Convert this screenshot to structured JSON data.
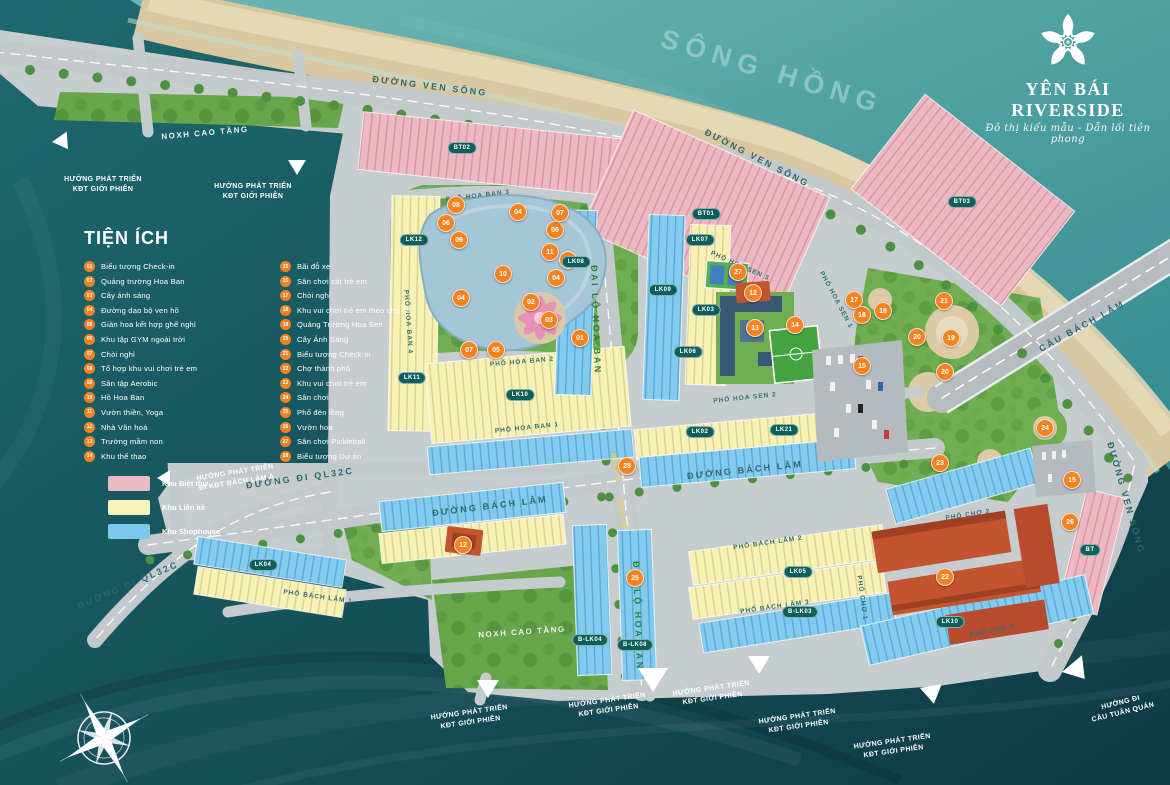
{
  "logo": {
    "title": "YÊN BÁI RIVERSIDE",
    "tagline": "Đô thị kiểu mẫu - Dẫn lối tiên phong"
  },
  "river_label": "SÔNG HỒNG",
  "legend": {
    "title": "TIỆN ÍCH",
    "items": [
      {
        "n": "01",
        "label": "Biểu tượng Check-in"
      },
      {
        "n": "02",
        "label": "Quảng trường Hoa Ban"
      },
      {
        "n": "03",
        "label": "Cây ánh sáng"
      },
      {
        "n": "04",
        "label": "Đường dạo bộ ven hồ"
      },
      {
        "n": "05",
        "label": "Giàn hoa kết hợp ghế nghỉ"
      },
      {
        "n": "06",
        "label": "Khu tập GYM ngoài trời"
      },
      {
        "n": "07",
        "label": "Chòi nghỉ"
      },
      {
        "n": "08",
        "label": "Tổ hợp khu vui chơi trẻ em"
      },
      {
        "n": "09",
        "label": "Sân tập Aerobic"
      },
      {
        "n": "10",
        "label": "Hồ Hoa Ban"
      },
      {
        "n": "11",
        "label": "Vườn thiền, Yoga"
      },
      {
        "n": "12",
        "label": "Nhà Văn hoá"
      },
      {
        "n": "13",
        "label": "Trường mầm non"
      },
      {
        "n": "14",
        "label": "Khu thể thao"
      },
      {
        "n": "15",
        "label": "Bãi đỗ xe"
      },
      {
        "n": "16",
        "label": "Sân chơi cát trẻ em"
      },
      {
        "n": "17",
        "label": "Chòi nghỉ"
      },
      {
        "n": "18",
        "label": "Khu vui chơi trẻ em theo chủ đề"
      },
      {
        "n": "19",
        "label": "Quảng Trường Hoa Sen"
      },
      {
        "n": "20",
        "label": "Cây Ánh Sáng"
      },
      {
        "n": "21",
        "label": "Biểu tượng Check-in"
      },
      {
        "n": "22",
        "label": "Chợ thành phố"
      },
      {
        "n": "23",
        "label": "Khu vui chơi trẻ em"
      },
      {
        "n": "24",
        "label": "Sân chơi"
      },
      {
        "n": "25",
        "label": "Phố đèn lồng"
      },
      {
        "n": "26",
        "label": "Vườn hoa"
      },
      {
        "n": "27",
        "label": "Sân chơi Pickleball"
      },
      {
        "n": "28",
        "label": "Biểu tượng Dự án"
      }
    ],
    "zones": [
      {
        "label": "Khu Biệt thự",
        "color": "#e9bcc4"
      },
      {
        "label": "Khu Liền kề",
        "color": "#f8f3b8"
      },
      {
        "label": "Khu Shophouse",
        "color": "#7cc9f0"
      }
    ]
  },
  "map": {
    "road_labels": [
      {
        "text": "ĐƯỜNG VEN SÔNG",
        "x": 430,
        "y": 86,
        "r": 7,
        "cls": "rl-main"
      },
      {
        "text": "ĐƯỜNG VEN SÔNG",
        "x": 757,
        "y": 158,
        "r": 27,
        "cls": "rl-main"
      },
      {
        "text": "ĐƯỜNG VEN SÔNG",
        "x": 1126,
        "y": 498,
        "r": 74,
        "cls": "rl-main"
      },
      {
        "text": "CẦU BÁCH LẪM",
        "x": 1082,
        "y": 326,
        "r": -29,
        "cls": "rl-main"
      },
      {
        "text": "ĐƯỜNG BÁCH LẪM",
        "x": 490,
        "y": 506,
        "r": -7,
        "cls": "rl-main"
      },
      {
        "text": "ĐƯỜNG BÁCH LẪM",
        "x": 745,
        "y": 470,
        "r": -6,
        "cls": "rl-main"
      },
      {
        "text": "ĐẠI LỘ HOA BAN",
        "x": 596,
        "y": 320,
        "r": 88,
        "cls": "rl-green"
      },
      {
        "text": "ĐẠI LỘ HOA BAN",
        "x": 638,
        "y": 616,
        "r": 88,
        "cls": "rl-green"
      },
      {
        "text": "ĐƯỜNG ĐI QL32C",
        "x": 300,
        "y": 478,
        "r": -8,
        "cls": "rl-main"
      },
      {
        "text": "ĐƯỜNG ĐI QL32C",
        "x": 128,
        "y": 585,
        "r": -23,
        "cls": "rl-main"
      },
      {
        "text": "PHỐ HOA BAN 1",
        "x": 527,
        "y": 428,
        "r": -6,
        "cls": "rl-street"
      },
      {
        "text": "PHỐ HOA BAN 2",
        "x": 522,
        "y": 362,
        "r": -5,
        "cls": "rl-street"
      },
      {
        "text": "PHỐ HOA BAN 3",
        "x": 478,
        "y": 196,
        "r": -7,
        "cls": "rl-street"
      },
      {
        "text": "PHỐ HOA BAN 4",
        "x": 408,
        "y": 322,
        "r": 86,
        "cls": "rl-street"
      },
      {
        "text": "PHỐ HOA SEN 1",
        "x": 836,
        "y": 300,
        "r": 62,
        "cls": "rl-street"
      },
      {
        "text": "PHỐ HOA SEN 2",
        "x": 745,
        "y": 398,
        "r": -6,
        "cls": "rl-street"
      },
      {
        "text": "PHỐ HOA SEN 3",
        "x": 740,
        "y": 266,
        "r": 24,
        "cls": "rl-street"
      },
      {
        "text": "PHỐ BÁCH LẪM 1",
        "x": 318,
        "y": 597,
        "r": 8,
        "cls": "rl-street"
      },
      {
        "text": "PHỐ BÁCH LẪM 2",
        "x": 768,
        "y": 543,
        "r": -8,
        "cls": "rl-street"
      },
      {
        "text": "PHỐ BÁCH LẪM 3",
        "x": 775,
        "y": 607,
        "r": -8,
        "cls": "rl-street"
      },
      {
        "text": "PHỐ CHỢ 1",
        "x": 862,
        "y": 598,
        "r": 82,
        "cls": "rl-street"
      },
      {
        "text": "PHỐ CHỢ 2",
        "x": 968,
        "y": 515,
        "r": -9,
        "cls": "rl-street"
      },
      {
        "text": "PHỐ CHỢ 3",
        "x": 992,
        "y": 631,
        "r": -11,
        "cls": "rl-street"
      },
      {
        "text": "KHU A",
        "x": 616,
        "y": 468,
        "r": 80,
        "cls": "rl-khu"
      },
      {
        "text": "KHU B",
        "x": 622,
        "y": 514,
        "r": 80,
        "cls": "rl-khu"
      }
    ],
    "area_labels": [
      {
        "text": "NOXH CAO TẦNG",
        "x": 205,
        "y": 133,
        "r": -5
      },
      {
        "text": "NOXH CAO TẦNG",
        "x": 522,
        "y": 632,
        "r": -4
      }
    ],
    "dir_labels": [
      {
        "lines": [
          "HƯỚNG PHÁT TRIỂN",
          "KĐT GIỚI PHIÊN"
        ],
        "x": 103,
        "y": 185,
        "r": 0
      },
      {
        "lines": [
          "HƯỚNG PHÁT TRIỂN",
          "KĐT GIỚI PHIÊN"
        ],
        "x": 253,
        "y": 192,
        "r": 0
      },
      {
        "lines": [
          "HƯỚNG PHÁT TRIỂN",
          "ĐI KĐT BÁCH LẪM A"
        ],
        "x": 236,
        "y": 478,
        "r": -9
      },
      {
        "lines": [
          "HƯỚNG PHÁT TRIỂN",
          "KĐT GIỚI PHIÊN"
        ],
        "x": 470,
        "y": 718,
        "r": -8
      },
      {
        "lines": [
          "HƯỚNG PHÁT TRIỂN",
          "KĐT GIỚI PHIÊN"
        ],
        "x": 608,
        "y": 706,
        "r": -8
      },
      {
        "lines": [
          "HƯỚNG PHÁT TRIỂN",
          "KĐT GIỚI PHIÊN"
        ],
        "x": 712,
        "y": 694,
        "r": -8
      },
      {
        "lines": [
          "HƯỚNG PHÁT TRIỂN",
          "KĐT GIỚI PHIÊN"
        ],
        "x": 798,
        "y": 722,
        "r": -8
      },
      {
        "lines": [
          "HƯỚNG PHÁT TRIỂN",
          "KĐT GIỚI PHIÊN"
        ],
        "x": 893,
        "y": 747,
        "r": -8
      },
      {
        "lines": [
          "HƯỚNG ĐI",
          "CẦU TUẦN QUÁN"
        ],
        "x": 1122,
        "y": 708,
        "r": -14
      }
    ],
    "markers": [
      {
        "n": "01",
        "x": 580,
        "y": 338
      },
      {
        "n": "02",
        "x": 531,
        "y": 302
      },
      {
        "n": "03",
        "x": 549,
        "y": 320
      },
      {
        "n": "04",
        "x": 518,
        "y": 212
      },
      {
        "n": "04",
        "x": 461,
        "y": 298
      },
      {
        "n": "04",
        "x": 556,
        "y": 278
      },
      {
        "n": "05",
        "x": 568,
        "y": 260
      },
      {
        "n": "05",
        "x": 496,
        "y": 350
      },
      {
        "n": "06",
        "x": 446,
        "y": 223
      },
      {
        "n": "06",
        "x": 555,
        "y": 230
      },
      {
        "n": "07",
        "x": 560,
        "y": 213
      },
      {
        "n": "07",
        "x": 469,
        "y": 350
      },
      {
        "n": "08",
        "x": 456,
        "y": 205
      },
      {
        "n": "09",
        "x": 459,
        "y": 240
      },
      {
        "n": "10",
        "x": 503,
        "y": 274
      },
      {
        "n": "11",
        "x": 550,
        "y": 252
      },
      {
        "n": "12",
        "x": 753,
        "y": 293
      },
      {
        "n": "12",
        "x": 463,
        "y": 545
      },
      {
        "n": "13",
        "x": 755,
        "y": 328
      },
      {
        "n": "14",
        "x": 795,
        "y": 325
      },
      {
        "n": "15",
        "x": 862,
        "y": 366
      },
      {
        "n": "15",
        "x": 1072,
        "y": 480
      },
      {
        "n": "16",
        "x": 862,
        "y": 315
      },
      {
        "n": "17",
        "x": 854,
        "y": 300
      },
      {
        "n": "18",
        "x": 883,
        "y": 311
      },
      {
        "n": "19",
        "x": 951,
        "y": 338
      },
      {
        "n": "20",
        "x": 917,
        "y": 337
      },
      {
        "n": "20",
        "x": 945,
        "y": 372
      },
      {
        "n": "21",
        "x": 944,
        "y": 301
      },
      {
        "n": "22",
        "x": 945,
        "y": 577
      },
      {
        "n": "23",
        "x": 940,
        "y": 463
      },
      {
        "n": "24",
        "x": 1045,
        "y": 428
      },
      {
        "n": "25",
        "x": 635,
        "y": 578
      },
      {
        "n": "26",
        "x": 1070,
        "y": 522
      },
      {
        "n": "27",
        "x": 738,
        "y": 272
      },
      {
        "n": "28",
        "x": 627,
        "y": 466
      }
    ],
    "blocks": [
      {
        "label": "BT01",
        "x": 706,
        "y": 214
      },
      {
        "label": "BT02",
        "x": 462,
        "y": 148
      },
      {
        "label": "BT03",
        "x": 962,
        "y": 202
      },
      {
        "label": "BT",
        "x": 1090,
        "y": 550
      },
      {
        "label": "LK02",
        "x": 700,
        "y": 432
      },
      {
        "label": "LK03",
        "x": 706,
        "y": 310
      },
      {
        "label": "LK04",
        "x": 263,
        "y": 565
      },
      {
        "label": "LK05",
        "x": 798,
        "y": 572
      },
      {
        "label": "LK06",
        "x": 688,
        "y": 352
      },
      {
        "label": "LK07",
        "x": 700,
        "y": 240
      },
      {
        "label": "LK08",
        "x": 576,
        "y": 262
      },
      {
        "label": "LK09",
        "x": 663,
        "y": 290
      },
      {
        "label": "LK10",
        "x": 520,
        "y": 395
      },
      {
        "label": "LK10",
        "x": 950,
        "y": 622
      },
      {
        "label": "LK11",
        "x": 412,
        "y": 378
      },
      {
        "label": "LK12",
        "x": 414,
        "y": 240
      },
      {
        "label": "LK21",
        "x": 784,
        "y": 430
      },
      {
        "label": "B-LK03",
        "x": 800,
        "y": 612
      },
      {
        "label": "B-LK04",
        "x": 590,
        "y": 640
      },
      {
        "label": "B-LK08",
        "x": 635,
        "y": 645
      }
    ]
  }
}
